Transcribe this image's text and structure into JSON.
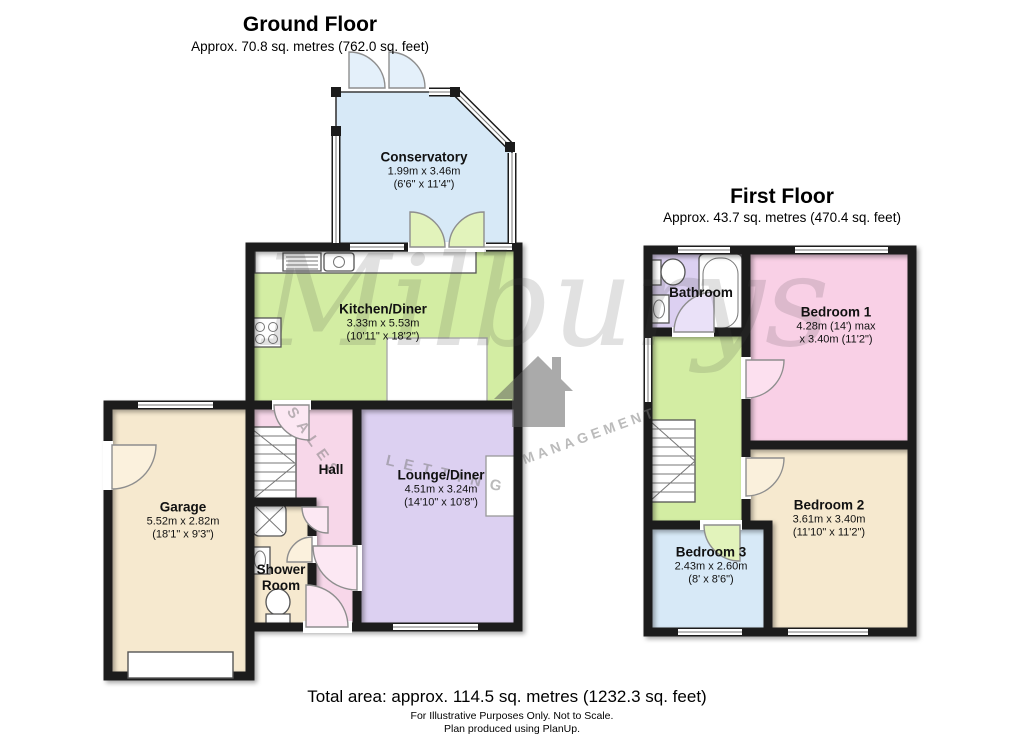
{
  "ground_floor": {
    "title": "Ground Floor",
    "subtitle": "Approx. 70.8 sq. metres (762.0 sq. feet)",
    "rooms": [
      {
        "name": "Conservatory",
        "dims_metric": "1.99m x 3.46m",
        "dims_imperial": "(6'6\" x 11'4\")"
      },
      {
        "name": "Kitchen/Diner",
        "dims_metric": "3.33m x 5.53m",
        "dims_imperial": "(10'11\" x 18'2\")"
      },
      {
        "name": "Hall"
      },
      {
        "name": "Garage",
        "dims_metric": "5.52m x 2.82m",
        "dims_imperial": "(18'1\" x 9'3\")"
      },
      {
        "name": "Shower Room"
      },
      {
        "name": "Lounge/Diner",
        "dims_metric": "4.51m x 3.24m",
        "dims_imperial": "(14'10\" x 10'8\")"
      }
    ]
  },
  "first_floor": {
    "title": "First Floor",
    "subtitle": "Approx. 43.7 sq. metres (470.4 sq. feet)",
    "rooms": [
      {
        "name": "Bathroom"
      },
      {
        "name": "Bedroom 1",
        "dims_metric": "4.28m (14') max",
        "dims_imperial": "x 3.40m (11'2\")"
      },
      {
        "name": "Bedroom 2",
        "dims_metric": "3.61m x 3.40m",
        "dims_imperial": "(11'10\" x 11'2\")"
      },
      {
        "name": "Bedroom 3",
        "dims_metric": "2.43m x 2.60m",
        "dims_imperial": "(8' x 8'6\")"
      }
    ]
  },
  "watermark": {
    "brand": "Milburys",
    "tagline_sales": "SALES",
    "tagline_letting": "LETTING",
    "tagline_management": "MANAGEMENT"
  },
  "footer": {
    "total_area": "Total area: approx. 114.5 sq. metres (1232.3 sq. feet)",
    "disclaimer_1": "For Illustrative Purposes Only. Not to Scale.",
    "disclaimer_2": "Plan produced using PlanUp."
  },
  "colors": {
    "walls": "#1b1b1b",
    "conservatory": "#d7e9f7",
    "kitchen": "#d3eda3",
    "hall": "#f7d7e9",
    "garage": "#f6e9cf",
    "shower_room": "#f6e9cf",
    "lounge": "#dcd0f1",
    "bathroom": "#dcd0f1",
    "bedroom1": "#f9d0e6",
    "bedroom2": "#f6e9cf",
    "bedroom3": "#d7e9f7",
    "landing": "#d3eda3"
  }
}
